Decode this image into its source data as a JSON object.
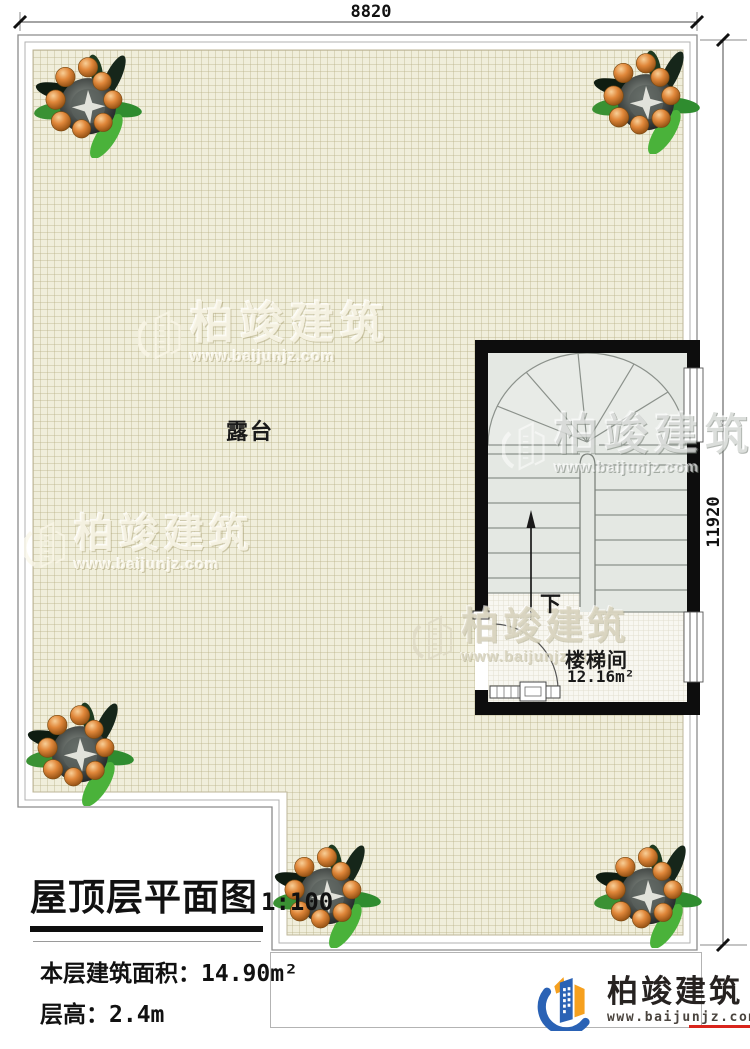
{
  "plan": {
    "terrace": "露台",
    "stair_room_name": "楼梯间",
    "stair_room_area": "12.16m²",
    "stair_direction": "下"
  },
  "dimensions": {
    "top": "8820",
    "right": "11920"
  },
  "title_block": {
    "title": "屋顶层平面图",
    "scale": "1:100",
    "area_label": "本层建筑面积：",
    "area_value": "14.90m²",
    "floor_height_label": "层高：",
    "floor_height_value": "2.4m"
  },
  "watermark": {
    "brand": "柏竣建筑",
    "url": "www.baijunjz.com"
  },
  "footer_logo": {
    "brand": "柏竣建筑",
    "url": "www.baijunjz.com"
  },
  "colors": {
    "wall": "#0d0d0d",
    "grid_background": "#f0eedb",
    "stair_fill": "#e4e8e3",
    "logo_blue": "#2a62b5",
    "logo_orange": "#f6a01e",
    "logo_red": "#d9251c"
  }
}
